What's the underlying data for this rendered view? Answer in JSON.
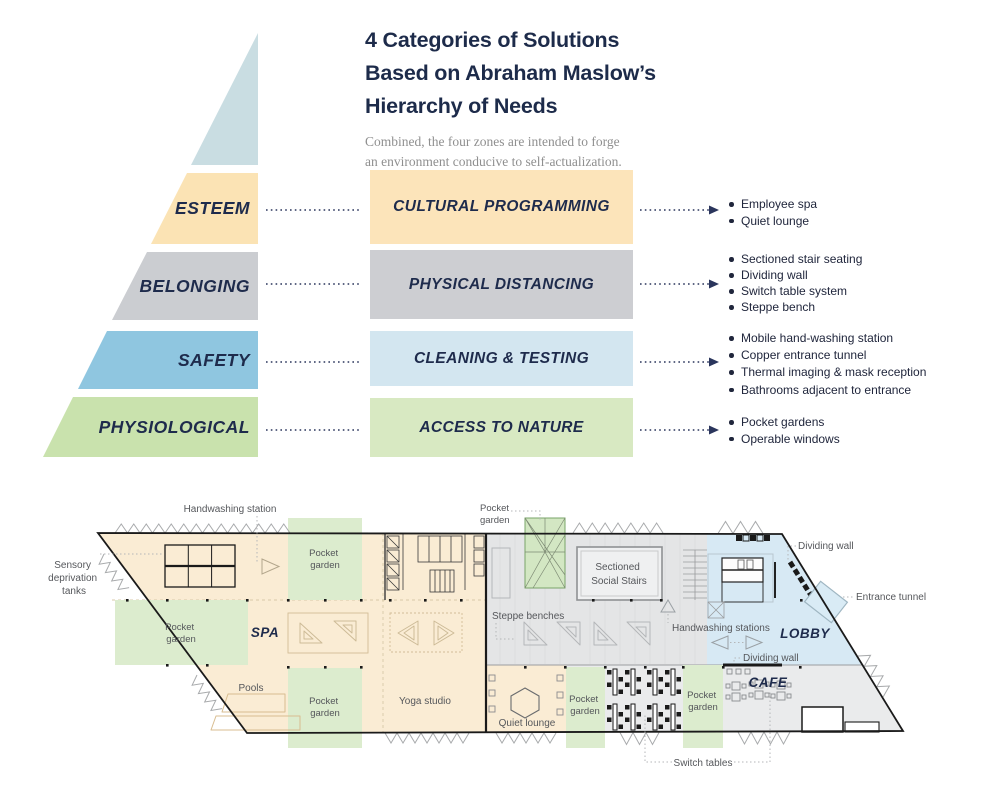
{
  "header": {
    "title_lines": [
      "4 Categories of Solutions",
      "Based on Abraham Maslow’s",
      "Hierarchy of Needs"
    ],
    "subtitle_lines": [
      "Combined, the four zones are intended to forge",
      "an environment conducive to self-actualization."
    ]
  },
  "pyramid": {
    "apex_color": "#c9dde2",
    "levels": [
      {
        "label": "ESTEEM",
        "color": "#fbe3b4"
      },
      {
        "label": "BELONGING",
        "color": "#cbcdd1"
      },
      {
        "label": "SAFETY",
        "color": "#8fc6e0"
      },
      {
        "label": "PHYSIOLOGICAL",
        "color": "#c9e2ad"
      }
    ]
  },
  "solutions": [
    {
      "label": "CULTURAL PROGRAMMING",
      "color": "#fce4ba",
      "items": [
        "Employee spa",
        "Quiet lounge"
      ]
    },
    {
      "label": "PHYSICAL DISTANCING",
      "color": "#cdced2",
      "items": [
        "Sectioned stair seating",
        "Dividing wall",
        "Switch table system",
        "Steppe bench"
      ]
    },
    {
      "label": "CLEANING & TESTING",
      "color": "#d3e6f0",
      "items": [
        "Mobile hand-washing station",
        "Copper entrance tunnel",
        "Thermal imaging & mask reception",
        "Bathrooms adjacent to entrance"
      ]
    },
    {
      "label": "ACCESS TO NATURE",
      "color": "#d8e9c2",
      "items": [
        "Pocket gardens",
        "Operable windows"
      ]
    }
  ],
  "floorplan": {
    "zones": {
      "spa": {
        "label": "SPA",
        "color": "#faecd4"
      },
      "lobby": {
        "label": "LOBBY",
        "color": "#d7e9f4"
      },
      "cafe": {
        "label": "CAFE",
        "color": "#eaebec"
      },
      "common_color": "#e4e5e6",
      "garden_color": "#dcecce"
    },
    "labels": {
      "handwashing_station": "Handwashing station",
      "sensory_lines": [
        "Sensory",
        "deprivation",
        "tanks"
      ],
      "pocket_garden_lines": [
        "Pocket",
        "garden"
      ],
      "pools": "Pools",
      "yoga_studio": "Yoga studio",
      "quiet_lounge": "Quiet lounge",
      "steppe_benches": "Steppe benches",
      "social_stairs_lines": [
        "Sectioned",
        "Social Stairs"
      ],
      "handwashing_stations": "Handwashing stations",
      "dividing_wall": "Dividing wall",
      "entrance_tunnel": "Entrance tunnel",
      "switch_tables": "Switch tables"
    }
  },
  "colors": {
    "navy": "#1e2b4c",
    "plan_text": "#55575b",
    "subtitle_gray": "#8f8f8f",
    "outline_black": "#1a1a1a"
  }
}
